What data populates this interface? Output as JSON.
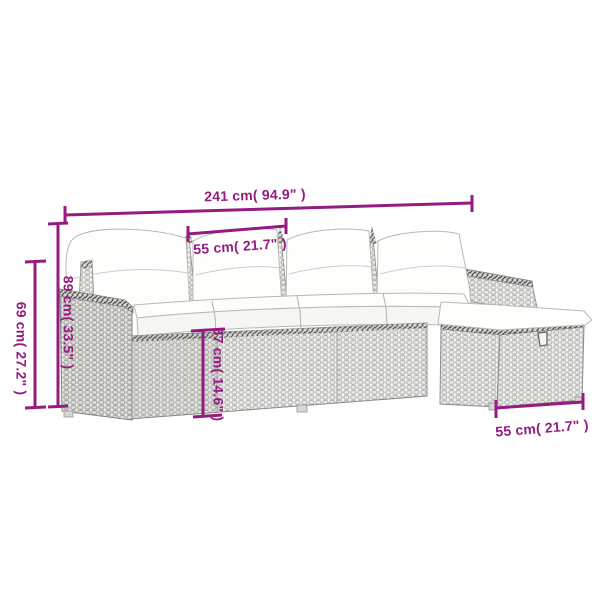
{
  "diagram": {
    "subject": "poly rattan garden sofa set with white cushions and ottoman",
    "style": "line-drawing product dimension diagram"
  },
  "colors": {
    "dimension": "#951b81"
  },
  "measurements": {
    "total_width": "241 cm( 94.9\" )",
    "seat_width": "55 cm( 21.7\" )",
    "armrest_height": "69 cm( 27.2\" )",
    "back_height": "89 cm( 33.5\" )",
    "base_height": "37 cm( 14.6\" )",
    "ottoman_depth": "55 cm( 21.7\" )"
  }
}
